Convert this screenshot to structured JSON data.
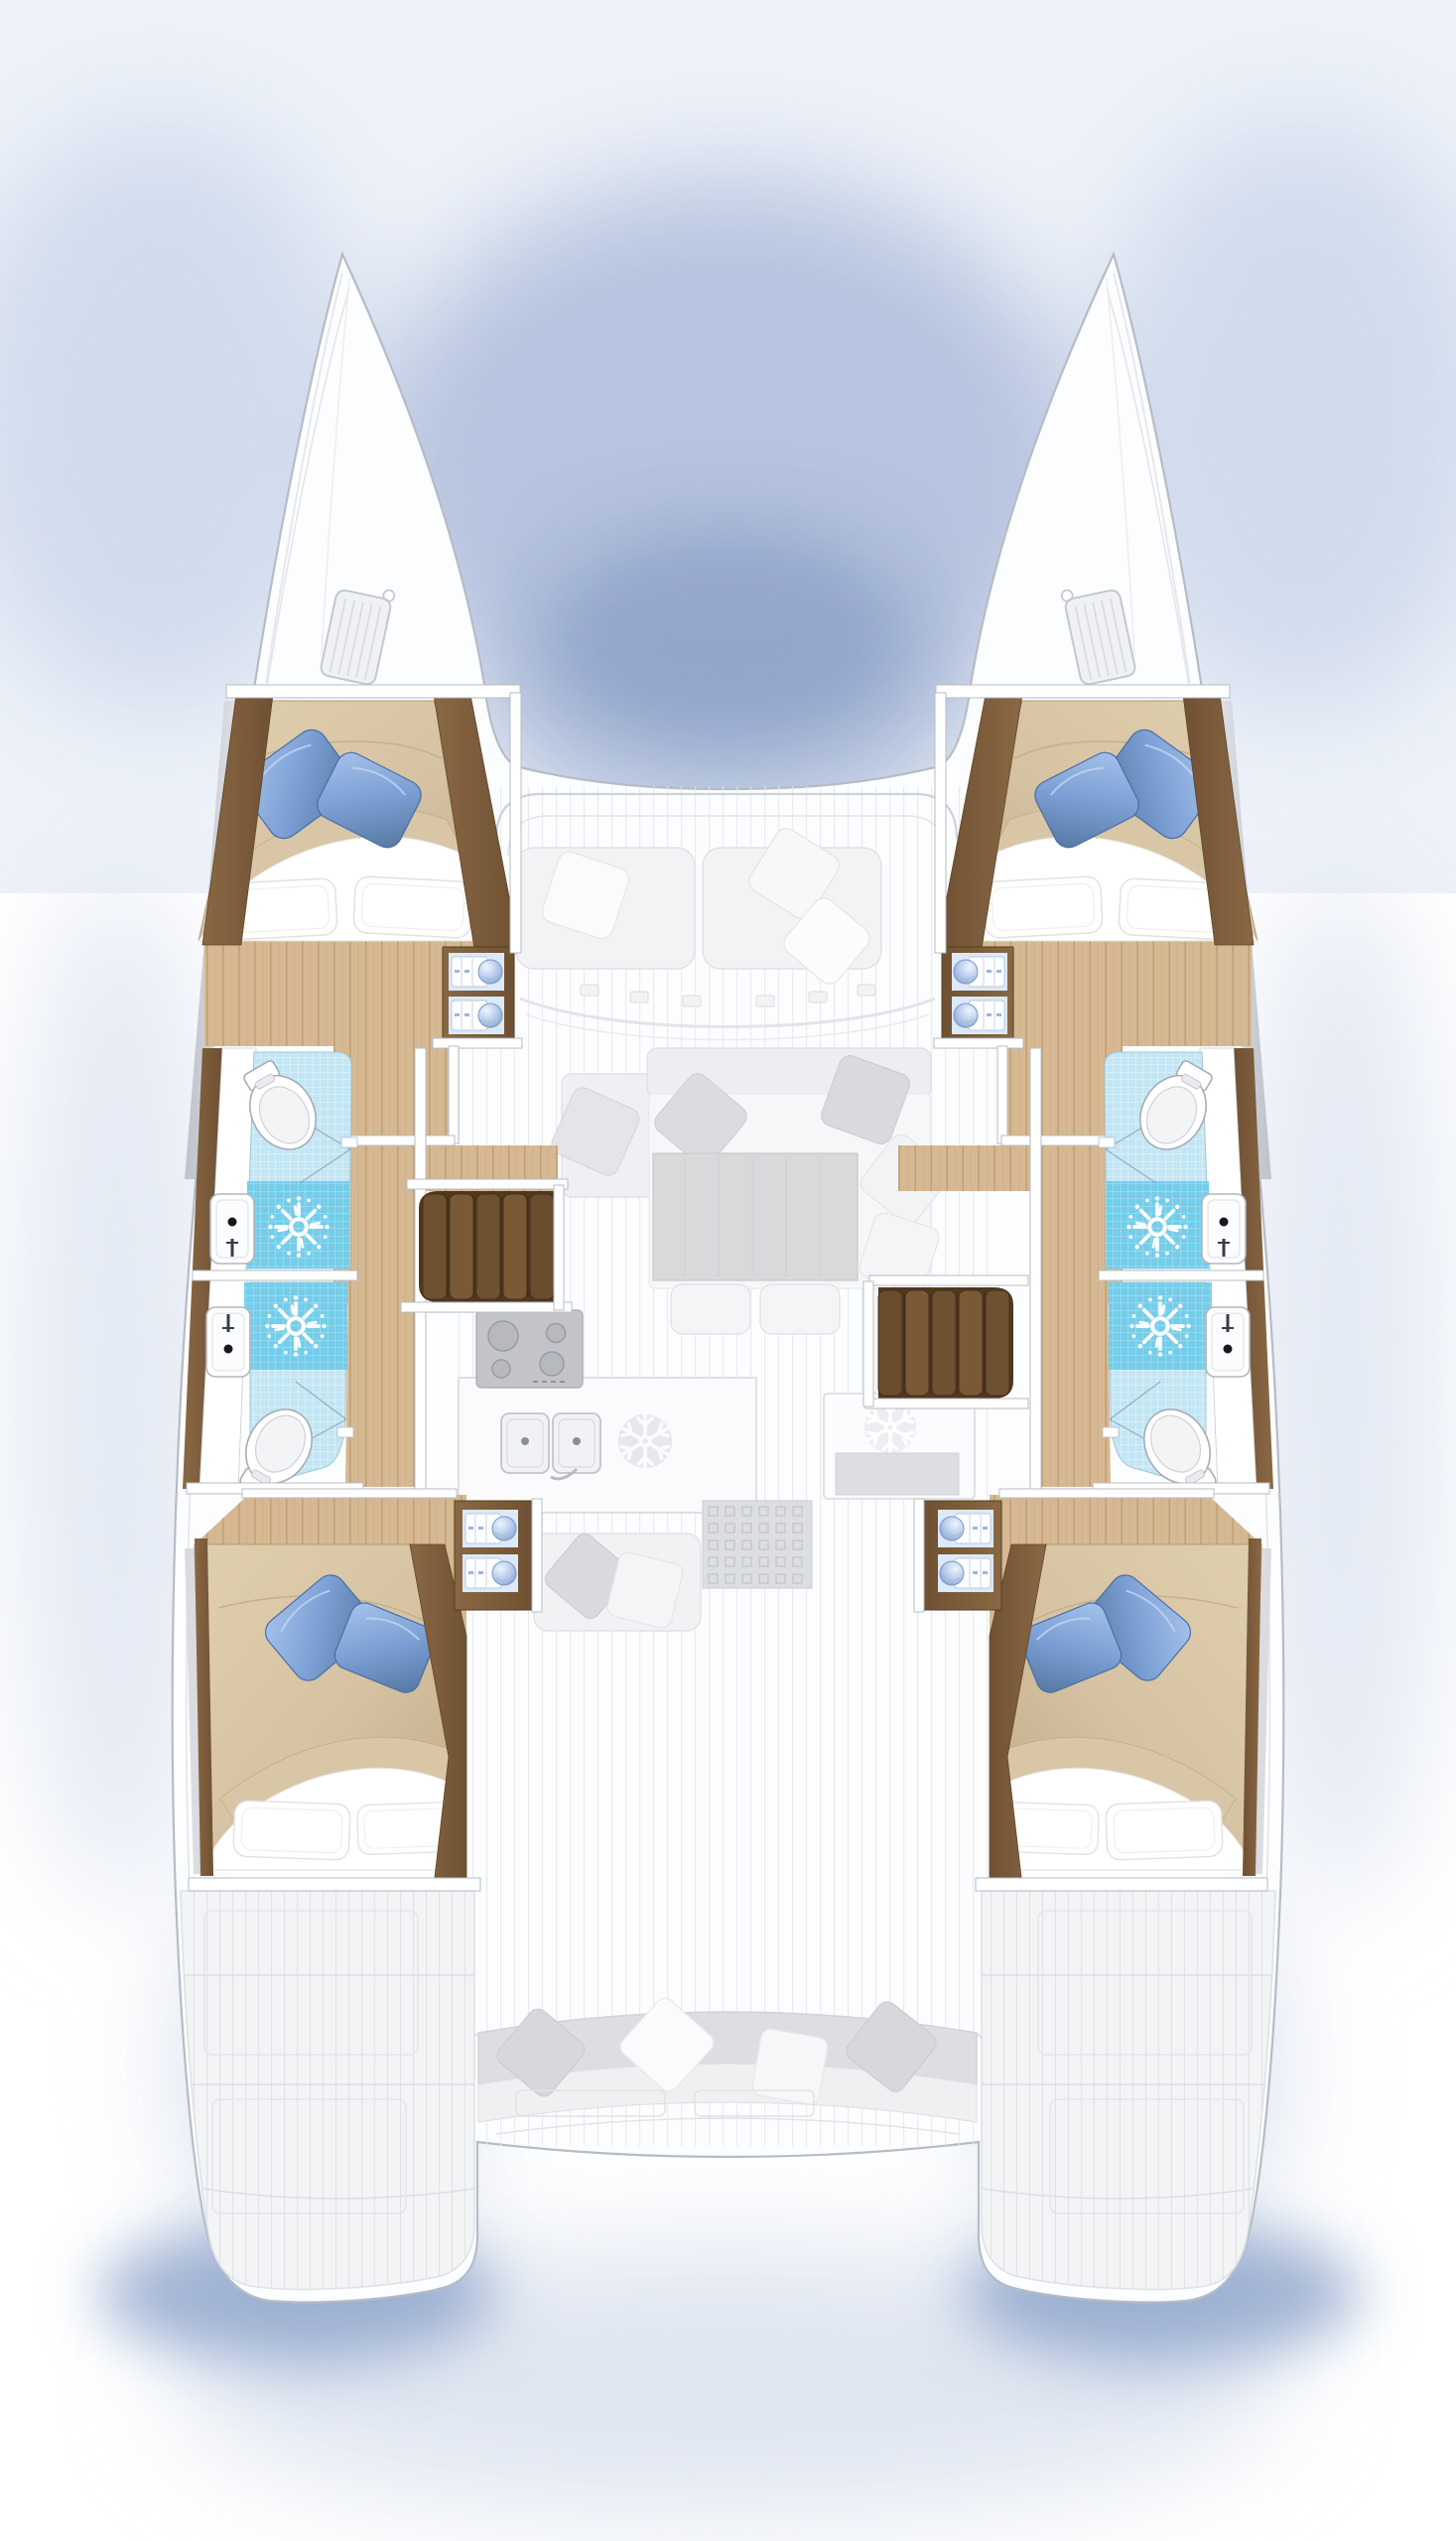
{
  "diagram": {
    "type": "yacht-floor-plan",
    "vessel": "catamaran",
    "view": "overhead deck plan, bow up",
    "hulls": 2,
    "layout_version": "4 cabins / 4 heads"
  },
  "rooms": [
    {
      "id": "cabin-port-forward",
      "kind": "double-cabin",
      "position": "port hull, forward",
      "features": [
        "double berth",
        "tan duvet",
        "2 white pillows",
        "2 blue accent pillows",
        "wood joinery",
        "vanity with 2 towel-and-bowl niches"
      ]
    },
    {
      "id": "cabin-starboard-forward",
      "kind": "double-cabin",
      "position": "starboard hull, forward",
      "features": [
        "double berth",
        "tan duvet",
        "2 white pillows",
        "2 blue accent pillows",
        "wood joinery",
        "vanity with 2 towel-and-bowl niches"
      ]
    },
    {
      "id": "cabin-port-aft",
      "kind": "double-cabin",
      "position": "port hull, aft",
      "features": [
        "double berth",
        "tan duvet",
        "2 white pillows",
        "2 blue accent pillows",
        "wood joinery",
        "vanity with 2 towel-and-bowl niches"
      ]
    },
    {
      "id": "cabin-starboard-aft",
      "kind": "double-cabin",
      "position": "starboard hull, aft",
      "features": [
        "double berth",
        "tan duvet",
        "2 white pillows",
        "2 blue accent pillows",
        "wood joinery",
        "vanity with 2 towel-and-bowl niches"
      ]
    },
    {
      "id": "head-port-forward",
      "kind": "bathroom",
      "position": "port hull, midship forward",
      "fixtures": [
        "toilet",
        "washbasin",
        "shower with rose"
      ],
      "floor": "light blue mosaic tile"
    },
    {
      "id": "head-port-aft",
      "kind": "bathroom",
      "position": "port hull, midship aft",
      "fixtures": [
        "toilet",
        "washbasin",
        "shower with rose"
      ],
      "floor": "light blue mosaic tile"
    },
    {
      "id": "head-starboard-forward",
      "kind": "bathroom",
      "position": "starboard hull, midship forward",
      "fixtures": [
        "toilet",
        "washbasin",
        "shower with rose"
      ],
      "floor": "light blue mosaic tile"
    },
    {
      "id": "head-starboard-aft",
      "kind": "bathroom",
      "position": "starboard hull, midship aft",
      "fixtures": [
        "toilet",
        "washbasin",
        "shower with rose"
      ],
      "floor": "light blue mosaic tile"
    },
    {
      "id": "saloon",
      "kind": "saloon",
      "position": "bridge deck, center",
      "render": "ghosted",
      "furniture": [
        "L-shaped sofa",
        "scatter cushions",
        "coffee table",
        "2 stools"
      ]
    },
    {
      "id": "galley",
      "kind": "galley",
      "position": "bridge deck, aft of saloon",
      "render": "ghosted",
      "appliances": [
        "4-burner cooktop",
        "double sink",
        "refrigerator (snowflake)",
        "freezer (snowflake)",
        "floor grate"
      ]
    },
    {
      "id": "foredeck-lounge",
      "kind": "seating",
      "position": "forward cockpit",
      "render": "ghosted",
      "furniture": [
        "2 bench cushions",
        "3 pillows"
      ]
    },
    {
      "id": "aft-cockpit",
      "kind": "cockpit",
      "position": "aft bridge deck",
      "render": "ghosted",
      "furniture": [
        "curved bench sofa",
        "4 pillows"
      ]
    },
    {
      "id": "swim-platform-port",
      "kind": "transom-platform",
      "render": "ghosted"
    },
    {
      "id": "swim-platform-starboard",
      "kind": "transom-platform",
      "render": "ghosted"
    }
  ],
  "circulation": {
    "companionways": [
      {
        "id": "stairs-port",
        "steps": 5,
        "position": "port, between galley and hull corridor"
      },
      {
        "id": "stairs-starboard",
        "steps": 5,
        "position": "starboard, slightly aft of port stairs"
      }
    ],
    "hull_corridors": 2
  },
  "fixture_counts": {
    "toilets": 4,
    "washbasins": 4,
    "shower_roses": 4,
    "berths": 4,
    "towel_niches": 8,
    "bow_hatches": 2
  },
  "colors": {
    "bg": "#ffffff",
    "skyShadow": "#a3b4d5",
    "skyShadowDeep": "#8ba1c9",
    "hull": "#fcfdfe",
    "hullLine": "#b6bcc6",
    "ghostFill": "#f2f3f5",
    "ghostMid": "#e6e8ec",
    "ghostDark": "#d8d9dc",
    "ghostStroke": "#d3d5d9",
    "woodTrim": "#7d5c3b",
    "woodDark": "#5f4528",
    "woodStep": "#6e5130",
    "floorWood": "#d6b992",
    "floorLine": "#c2a076",
    "duvet": "#d5c2a2",
    "duvetDeep": "#c2ab87",
    "sheet": "#ffffff",
    "pillowBlue": "#7b9fd4",
    "pillowBlueDark": "#4a6da6",
    "tile": "#c2e6f3",
    "shower": "#74cde9",
    "fixtureStroke": "#a6acb5",
    "towelBowl": "#8fb0dd"
  }
}
